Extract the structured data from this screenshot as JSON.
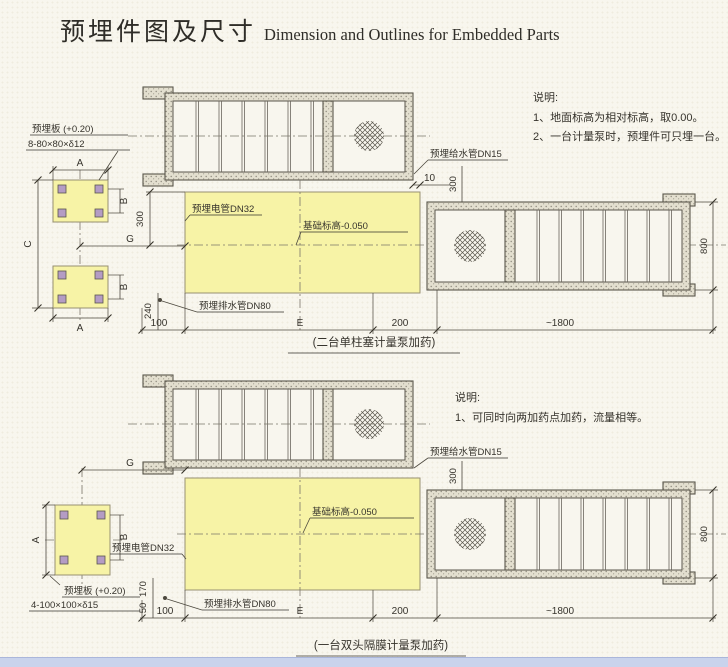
{
  "colors": {
    "foundation_fill": "#f7f3a6",
    "window_strip": "#c9d3ec",
    "background": "#f8f6ee"
  },
  "title": {
    "zh": "预埋件图及尺寸",
    "en": "Dimension and Outlines for Embedded Parts"
  },
  "drawing1": {
    "caption": "(二台单柱塞计量泵加药)",
    "notes": {
      "title": "说明:",
      "items": [
        "1、地面标高为相对标高，取0.00。",
        "2、一台计量泵时，预埋件可只埋一台。"
      ]
    },
    "labels": {
      "plate": "预埋板 (+0.20)",
      "plate_spec": "8-80×80×δ12",
      "conduit": "预埋电管DN32",
      "level": "基础标高-0.050",
      "water": "预埋给水管DN15",
      "drain": "预埋排水管DN80"
    },
    "dims": {
      "a": "A",
      "b": "B",
      "c": "C",
      "g": "G",
      "gap": "10",
      "v300_left": "300",
      "v300_right": "300",
      "v240": "240",
      "d100": "100",
      "e": "E",
      "d200": "200",
      "length": "~1800",
      "height": "800"
    }
  },
  "drawing2": {
    "caption": "(一台双头隔膜计量泵加药)",
    "notes": {
      "title": "说明:",
      "items": [
        "1、可同时向两加药点加药，流量相等。"
      ]
    },
    "labels": {
      "plate": "预埋板 (+0.20)",
      "plate_spec": "4-100×100×δ15",
      "conduit": "预埋电管DN32",
      "level": "基础标高-0.050",
      "water": "预埋给水管DN15",
      "drain": "预埋排水管DN80"
    },
    "dims": {
      "a": "A",
      "b": "B",
      "g": "G",
      "v300_right": "300",
      "v170": "170",
      "v50": "50",
      "d100": "100",
      "e": "E",
      "d200": "200",
      "length": "~1800",
      "height": "800"
    }
  }
}
